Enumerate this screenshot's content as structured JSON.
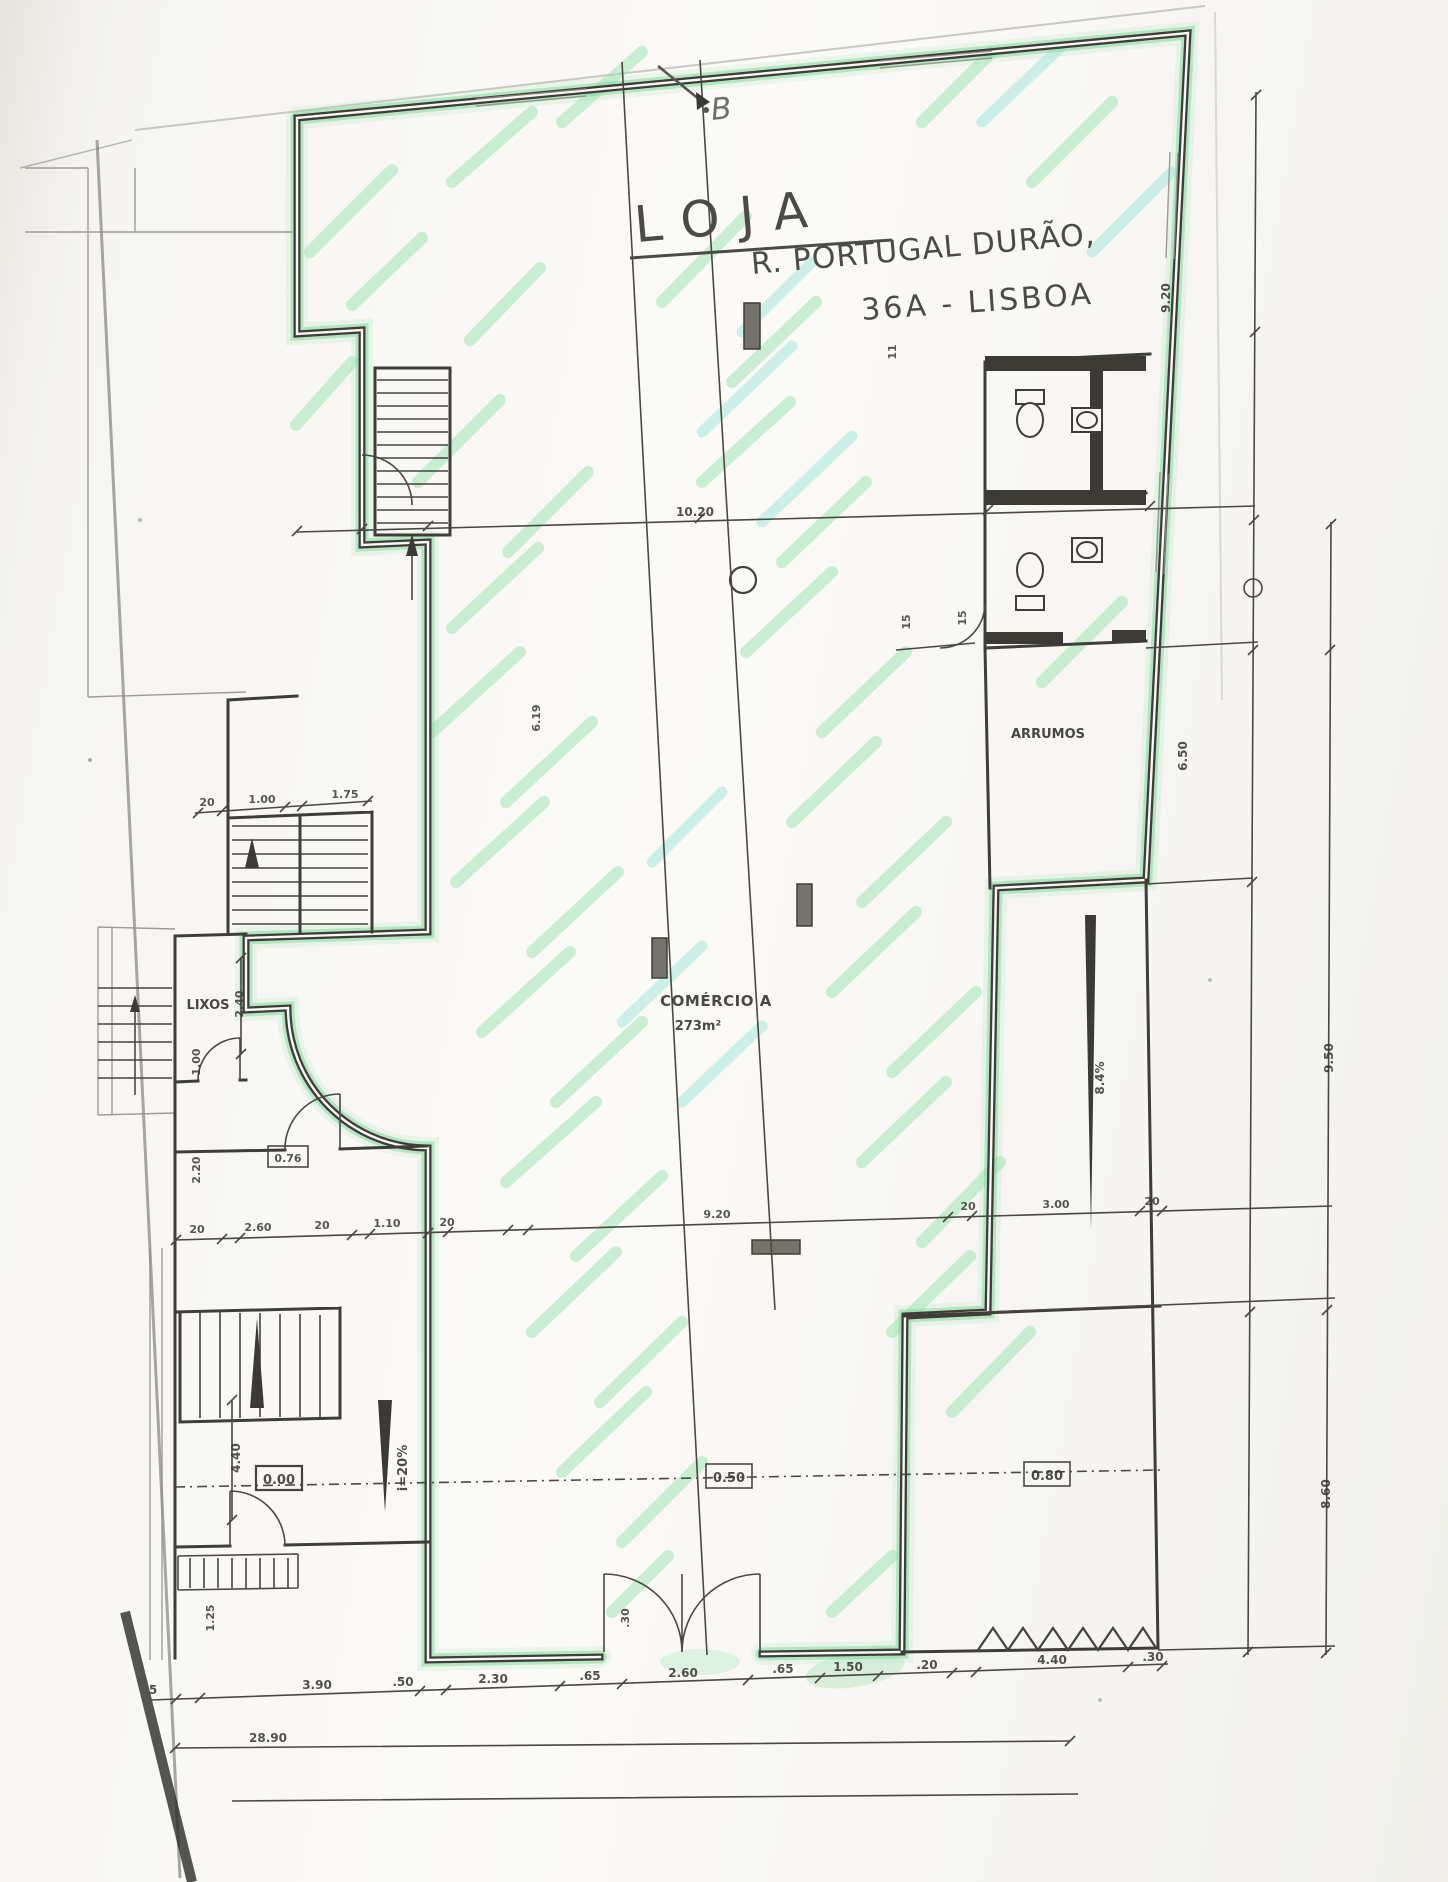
{
  "title": {
    "name": "LOJA",
    "street": "R. PORTUGAL DURÃO,",
    "number_city": "36A - LISBOA"
  },
  "section": {
    "marker": "B"
  },
  "rooms": {
    "comercio": {
      "label": "COMÉRCIO A",
      "area": "273m²"
    },
    "arrumos": {
      "label": "ARRUMOS"
    },
    "lixos": {
      "label": "LIXOS"
    }
  },
  "levels": {
    "entry": "0.00",
    "mid": "0.50",
    "rear": "0.80",
    "small_box": "0.76"
  },
  "slopes": {
    "entry_ramp": "i=20%",
    "side_ramp": "8.4%"
  },
  "dimensions": {
    "overall": "28.90",
    "top_span": "10.20",
    "right_upper": "9.20",
    "right_storage": "6.50",
    "right_mid": "9.50",
    "right_lower": "8.60",
    "stair_chain": [
      "20",
      "1.00",
      "1.75"
    ],
    "mid_chain": [
      "20",
      "2.60",
      "20",
      "1.10",
      "20",
      "9.20",
      "20",
      "3.00",
      "20"
    ],
    "bottom_chain": [
      "5",
      "3.90",
      ".50",
      "2.30",
      ".65",
      "2.60",
      ".65",
      "1.50",
      ".20",
      "4.40",
      ".30"
    ],
    "left_lixos": "2.40",
    "left_wall_upper": "1.00",
    "left_wall_lower": "2.20",
    "left_stair": "4.40",
    "left_bottom": "1.25",
    "door_width": ".30",
    "wc_a": "15",
    "wc_b": "15",
    "wc_c": "11",
    "section_len": "6.19"
  }
}
